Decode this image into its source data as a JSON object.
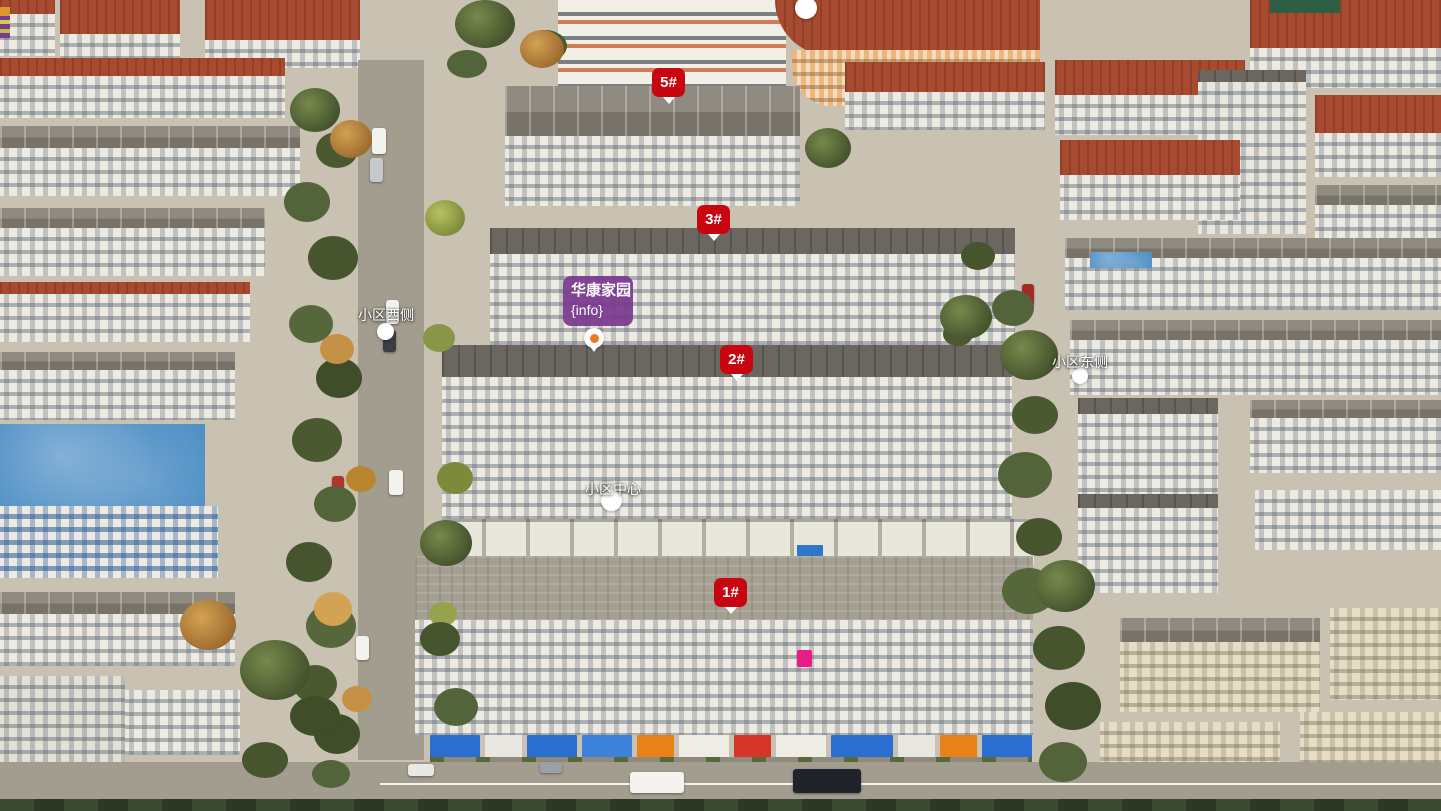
{
  "overlay": {
    "building_badges": [
      {
        "label": "5#"
      },
      {
        "label": "3#"
      },
      {
        "label": "2#"
      },
      {
        "label": "1#"
      }
    ],
    "community_label": {
      "title": "华康家园",
      "subtitle": "{info}"
    },
    "area_markers": [
      {
        "label": "小区西侧"
      },
      {
        "label": "小区东侧"
      },
      {
        "label": "小区中心"
      }
    ],
    "colors": {
      "badge_red": "#c7060f",
      "label_purple": "#7b3a90",
      "pin_orange": "#f07a22",
      "marker_white": "#ffffff"
    }
  }
}
